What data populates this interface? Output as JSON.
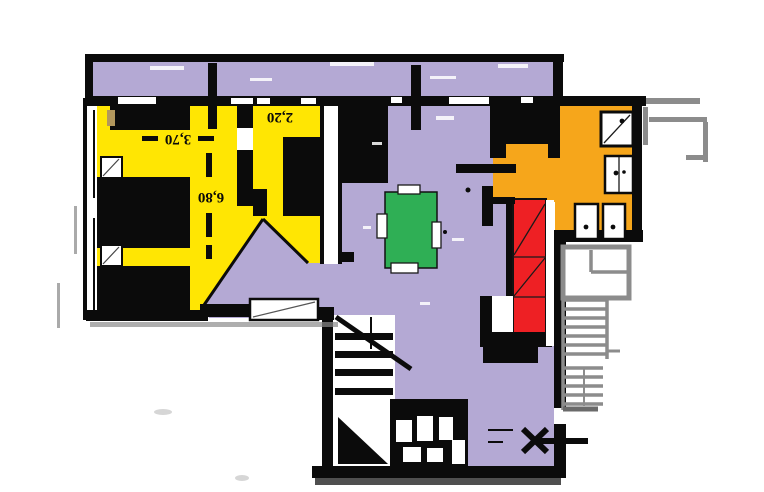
{
  "plan": {
    "title": "hand-colored apartment floor plan",
    "labels": {
      "bedroom_width": "3,70",
      "bedroom_length": "6,80",
      "small_room_width": "2,20"
    },
    "colors": {
      "bedroom": "#FFE603",
      "living": "#B4A9D4",
      "bathroom": "#F6A61B",
      "wardrobe": "#EE2024",
      "table": "#2FAF55",
      "wall": "#0B0B0B",
      "sketch": "#8C8C8C",
      "background": "#FFFFFF"
    },
    "rooms": [
      {
        "id": "bedroom",
        "note": "yellow room with beds and nightstands"
      },
      {
        "id": "small-room",
        "note": "yellow room labeled 2,20"
      },
      {
        "id": "living-room",
        "note": "lavender room with green table, red wardrobe"
      },
      {
        "id": "bathroom",
        "note": "orange room with shower, sink, WC, bidet"
      },
      {
        "id": "balcony",
        "note": "lavender strip along top"
      },
      {
        "id": "stairwell",
        "note": "interior stairs bottom center, exterior stairs right"
      }
    ]
  }
}
